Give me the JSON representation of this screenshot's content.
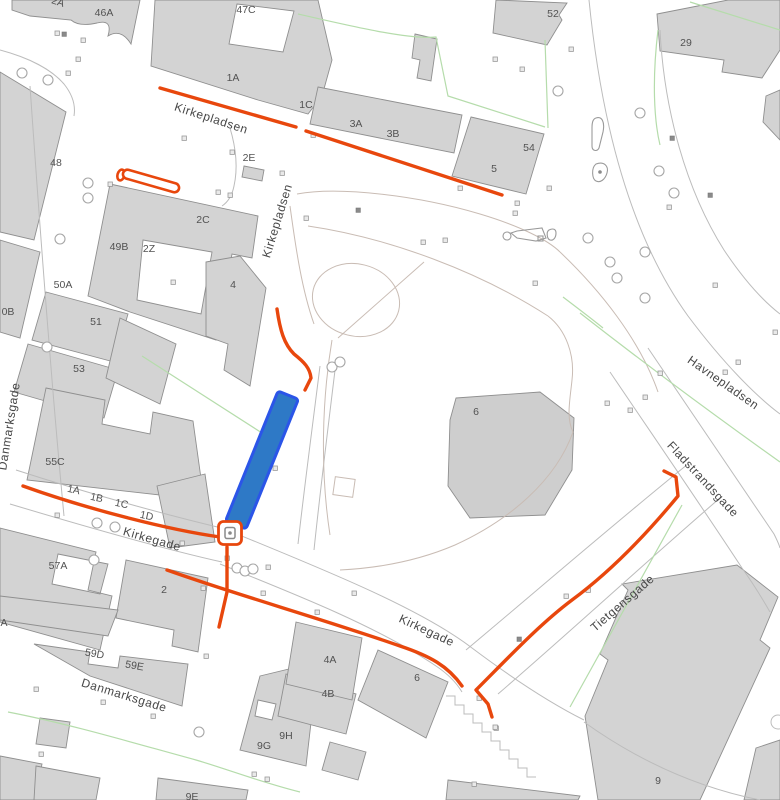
{
  "map": {
    "title": "city-parcel-map",
    "colors": {
      "background": "#ffffff",
      "building_fill": "#d3d3d3",
      "building_stroke": "#8f8f8f",
      "road_stroke": "#bcbcbc",
      "path_stroke": "#c9bcb4",
      "green_stroke": "#b5dcab",
      "route": "#e8470d",
      "highlight_fill": "#2e79c6",
      "highlight_stroke": "#2b55e8",
      "label": "#4f4f4f"
    },
    "streets": [
      {
        "text": "Kirkepladsen"
      },
      {
        "text": "Kirkepladsen"
      },
      {
        "text": "Danmarksgade"
      },
      {
        "text": "Kirkegade"
      },
      {
        "text": "Kirkegade"
      },
      {
        "text": "Danmarksgade"
      },
      {
        "text": "Havnepladsen"
      },
      {
        "text": "Fladstrandsgade"
      },
      {
        "text": "Tietgensgade"
      }
    ],
    "buildings": [
      {
        "text": "2A"
      },
      {
        "text": "46A"
      },
      {
        "text": "47C"
      },
      {
        "text": "52"
      },
      {
        "text": "29"
      },
      {
        "text": "1A"
      },
      {
        "text": "1C"
      },
      {
        "text": "3A"
      },
      {
        "text": "3B"
      },
      {
        "text": "54"
      },
      {
        "text": "5"
      },
      {
        "text": "48"
      },
      {
        "text": "2E"
      },
      {
        "text": "2C"
      },
      {
        "text": "49B"
      },
      {
        "text": "2Z"
      },
      {
        "text": "50A"
      },
      {
        "text": "0B"
      },
      {
        "text": "51"
      },
      {
        "text": "4"
      },
      {
        "text": "53"
      },
      {
        "text": "6"
      },
      {
        "text": "55C"
      },
      {
        "text": "1A"
      },
      {
        "text": "1B"
      },
      {
        "text": "1C"
      },
      {
        "text": "1D"
      },
      {
        "text": "57A"
      },
      {
        "text": "2"
      },
      {
        "text": "A"
      },
      {
        "text": "59D"
      },
      {
        "text": "59E"
      },
      {
        "text": "4A"
      },
      {
        "text": "4B"
      },
      {
        "text": "6"
      },
      {
        "text": "9H"
      },
      {
        "text": "9G"
      },
      {
        "text": "9"
      },
      {
        "text": "9E"
      }
    ],
    "icons": [
      {
        "name": "route-marker-icon"
      },
      {
        "name": "route-start-ring-icon"
      },
      {
        "name": "playground-icon"
      },
      {
        "name": "shield-icon"
      },
      {
        "name": "tree-icon"
      },
      {
        "name": "lamp-dot-icon"
      }
    ]
  }
}
